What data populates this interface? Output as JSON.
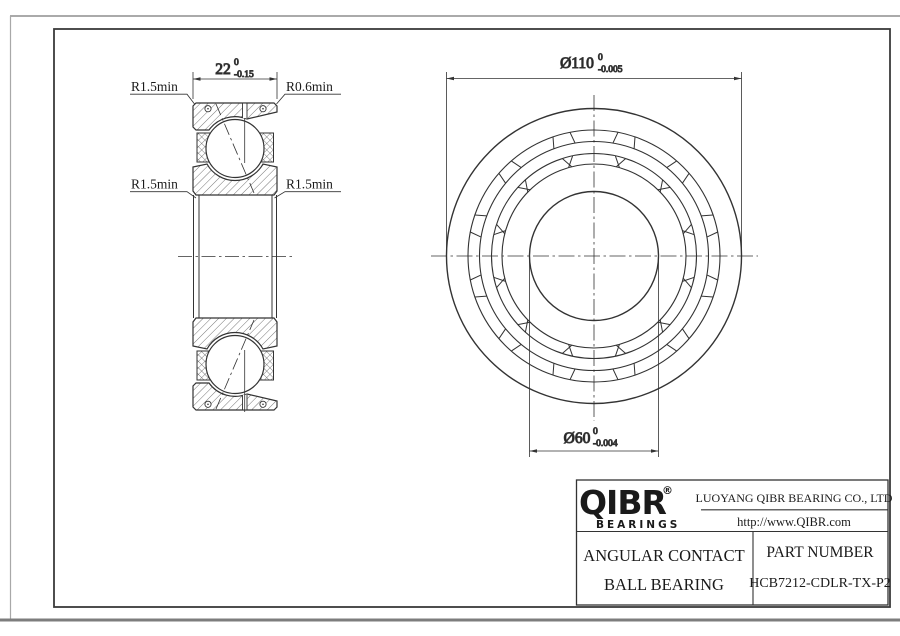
{
  "section_view": {
    "dim_width": {
      "text": "22",
      "tol_top": "0",
      "tol_bottom": "-0.15"
    },
    "label_top_left": "R1.5min",
    "label_top_right": "R0.6min",
    "label_mid_left": "R1.5min",
    "label_mid_right": "R1.5min"
  },
  "front_view": {
    "dim_outer": {
      "text": "Ø110",
      "tol_top": "0",
      "tol_bottom": "-0.005"
    },
    "dim_bore": {
      "text": "Ø60",
      "tol_top": "0",
      "tol_bottom": "-0.004"
    }
  },
  "title_block": {
    "logo": "QIBR",
    "logo_reg": "®",
    "logo_sub": "BEARINGS",
    "company": "LUOYANG QIBR BEARING CO., LTD",
    "website": "http://www.QIBR.com",
    "product_line1": "ANGULAR CONTACT",
    "product_line2": "BALL BEARING",
    "part_label": "PART NUMBER",
    "part_number": "HCB7212-CDLR-TX-P2"
  }
}
